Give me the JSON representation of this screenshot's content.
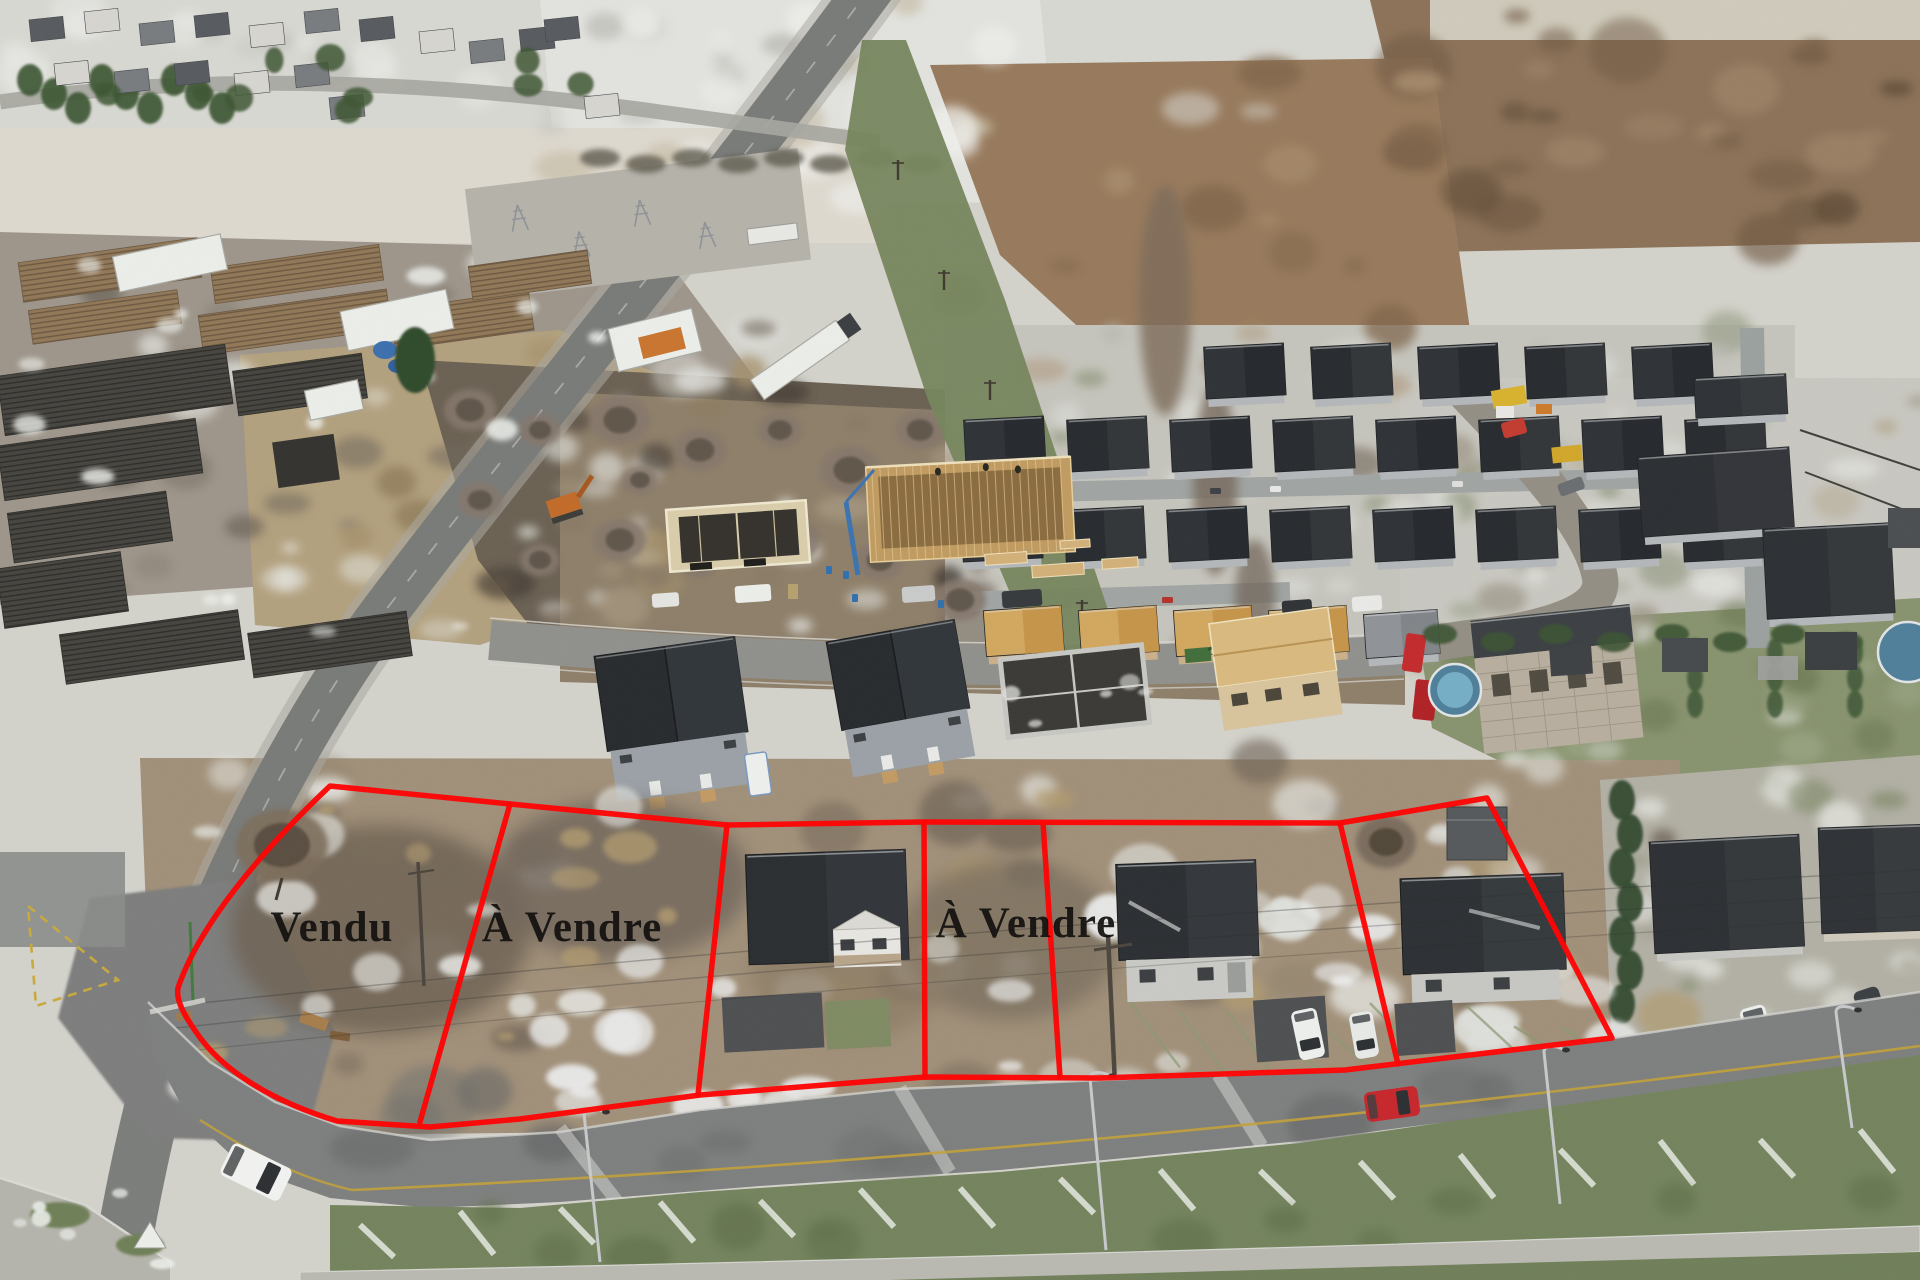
{
  "meta": {
    "scene": "aerial-drone-photo-winter-subdivision"
  },
  "overlay": {
    "outline_color": "#ff0000",
    "label_color": "#0e0c0a",
    "labels": [
      {
        "id": "lot-1",
        "text": "Vendu"
      },
      {
        "id": "lot-2",
        "text": "À Vendre"
      },
      {
        "id": "lot-4",
        "text": "À Vendre"
      }
    ]
  },
  "lots": [
    {
      "n": 1,
      "label": "Vendu"
    },
    {
      "n": 2,
      "label": "À Vendre"
    },
    {
      "n": 3,
      "label": ""
    },
    {
      "n": 4,
      "label": "À Vendre"
    },
    {
      "n": 5,
      "label": ""
    },
    {
      "n": 6,
      "label": ""
    }
  ],
  "palette": {
    "snow": "#e7e8e4",
    "dirt": "#8d7e68",
    "mud": "#6e6255",
    "asphalt": "#7d7f7e",
    "grass": "#73835c",
    "roof_dark": "#2b2e32",
    "wall_light": "#b3b7ba",
    "framing_tan": "#c49a5f",
    "car_red": "#c6252a",
    "car_white": "#f2f3f1",
    "road_paint_yellow": "#c2a138"
  }
}
